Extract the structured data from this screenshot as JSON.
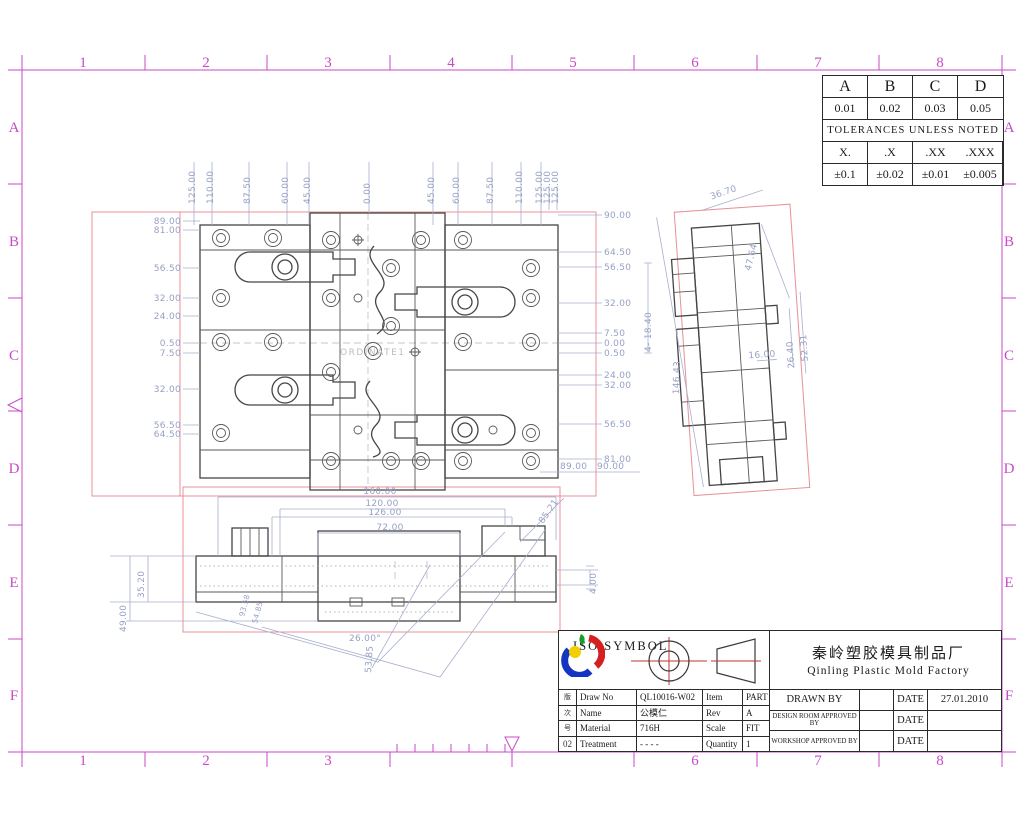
{
  "sheet": {
    "zone_cols": [
      "1",
      "2",
      "3",
      "4",
      "5",
      "6",
      "7",
      "8"
    ],
    "bottom_cols": [
      "1",
      "2",
      "3",
      "6",
      "7",
      "8"
    ],
    "zone_rows": [
      "A",
      "B",
      "C",
      "D",
      "E",
      "F"
    ],
    "frame_color": "#c84ac8",
    "dim_color": "#97a1c5",
    "viewport_color": "#e89098"
  },
  "tolerance_table": {
    "headers": [
      "A",
      "B",
      "C",
      "D"
    ],
    "values": [
      "0.01",
      "0.02",
      "0.03",
      "0.05"
    ],
    "note": "TOLERANCES UNLESS NOTED",
    "precision_headers": [
      "X.",
      ".X",
      ".XX",
      ".XXX"
    ],
    "precision_values": [
      "±0.1",
      "±0.02",
      "±0.01",
      "±0.005"
    ]
  },
  "title_block": {
    "iso_symbol_label": "ISO SYMBOL",
    "company_cn": "秦岭塑胶模具制品厂",
    "company_en": "Qinling Plastic Mold Factory",
    "rev_col": {
      "chars": [
        "版",
        "次",
        "号"
      ],
      "value": "02"
    },
    "fields": {
      "draw_no_label": "Draw No",
      "draw_no": "QL10016-W02",
      "item_label": "Item",
      "item": "PART",
      "name_label": "Name",
      "name": "公模仁",
      "rev_label": "Rev",
      "rev": "A",
      "material_label": "Material",
      "material": "716H",
      "scale_label": "Scale",
      "scale": "FIT",
      "treatment_label": "Treatment",
      "treatment": "- - - -",
      "quantity_label": "Quantity",
      "quantity": "1"
    },
    "signoff": {
      "drawn_by_label": "DRAWN BY",
      "design_label": "DESIGN ROOM APPROVED BY",
      "workshop_label": "WORKSHOP APPROVED BY",
      "date_label": "DATE",
      "drawn_date": "27.01.2010"
    }
  },
  "main_view": {
    "center_label": "ORDINATE1",
    "top_dims": [
      "125.00",
      "110.00",
      "87.50",
      "60.00",
      "45.00",
      "0.00",
      "45.00",
      "60.00",
      "87.50",
      "110.00",
      "125.00",
      "125.00",
      "125.00"
    ],
    "left_dims": [
      "89.00",
      "81.00",
      "56.50",
      "32.00",
      "24.00",
      "0.50",
      "7.50",
      "32.00",
      "56.50",
      "64.50"
    ],
    "right_dims": [
      "90.00",
      "64.50",
      "56.50",
      "32.00",
      "7.50",
      "0.00",
      "0.50",
      "24.00",
      "32.00",
      "56.50",
      "81.00",
      "89.00",
      "90.00"
    ],
    "right_note": "4- 18.40"
  },
  "side_view": {
    "dims": [
      "36.70",
      "47.64",
      "26.40",
      "52.31",
      "146.43",
      "16.00"
    ]
  },
  "bottom_view": {
    "dims": [
      "160.00",
      "120.00",
      "126.00",
      "72.00",
      "35.20",
      "49.00",
      "26.00°",
      "53.85",
      "85.21",
      "4.00",
      "93.58",
      "54.85"
    ]
  }
}
